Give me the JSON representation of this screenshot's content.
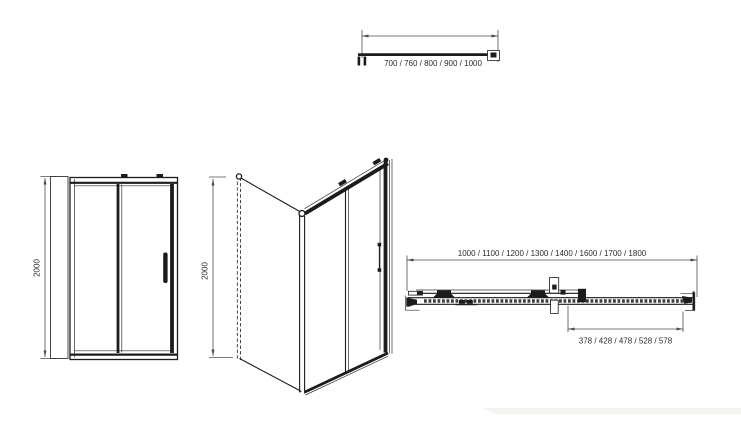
{
  "colors": {
    "line": "#1c1c1c",
    "dimension": "#4d4d4d",
    "text": "#2b2b2b",
    "watermark": "#f6f4f1"
  },
  "views": {
    "side_panel_plan": {
      "width_options": "700 / 760 / 800 / 900 / 1000"
    },
    "front_elevation": {
      "height": "2000"
    },
    "perspective": {
      "height": "2000"
    },
    "door_plan": {
      "width_options": "1000 / 1100 / 1200 / 1300 / 1400 / 1600 / 1700 / 1800",
      "entry_options": "378 / 428 / 478 / 528 / 578"
    }
  }
}
